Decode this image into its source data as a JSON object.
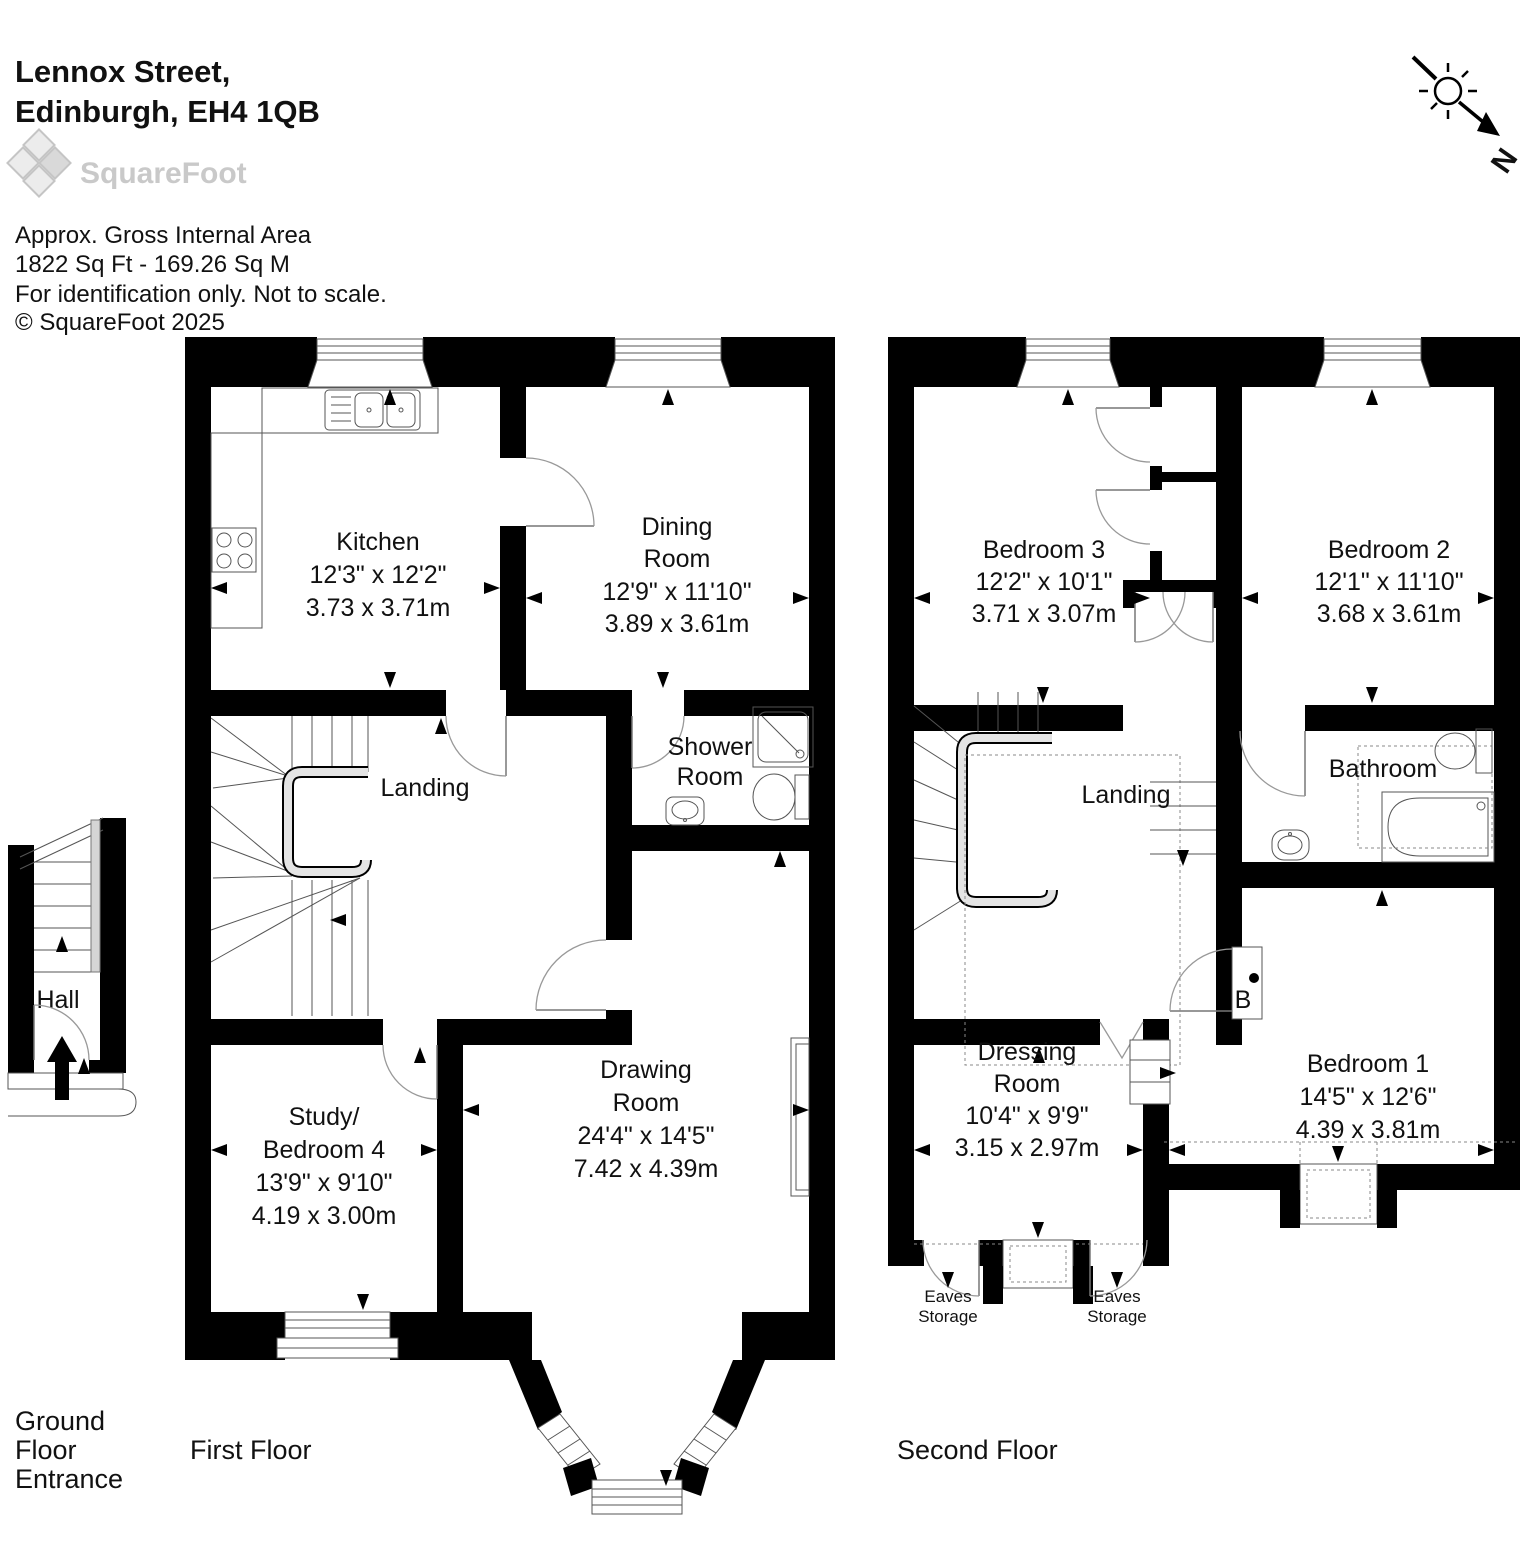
{
  "header": {
    "title_line1": "Lennox Street,",
    "title_line2": "Edinburgh, EH4 1QB",
    "logo": "SquareFoot",
    "area_line1": "Approx. Gross Internal Area",
    "area_line2": "1822 Sq Ft  -  169.26 Sq M",
    "area_line3": "For identification only. Not to scale.",
    "area_line4": "© SquareFoot 2025"
  },
  "compass": {
    "north_label": "N"
  },
  "floor_labels": {
    "ground_line1": "Ground",
    "ground_line2": "Floor",
    "ground_line3": "Entrance",
    "first": "First Floor",
    "second": "Second Floor"
  },
  "rooms": {
    "hall": {
      "name": "Hall"
    },
    "kitchen": {
      "name": "Kitchen",
      "ft": "12'3\" x 12'2\"",
      "m": "3.73 x 3.71m"
    },
    "dining": {
      "name1": "Dining",
      "name2": "Room",
      "ft": "12'9\" x 11'10\"",
      "m": "3.89 x 3.61m"
    },
    "landing_first": {
      "name": "Landing"
    },
    "shower": {
      "name1": "Shower",
      "name2": "Room"
    },
    "study": {
      "name1": "Study/",
      "name2": "Bedroom 4",
      "ft": "13'9\" x 9'10\"",
      "m": "4.19 x 3.00m"
    },
    "drawing": {
      "name1": "Drawing",
      "name2": "Room",
      "ft": "24'4\" x 14'5\"",
      "m": "7.42 x 4.39m"
    },
    "bedroom3": {
      "name": "Bedroom 3",
      "ft": "12'2\" x 10'1\"",
      "m": "3.71 x 3.07m"
    },
    "bedroom2": {
      "name": "Bedroom 2",
      "ft": "12'1\" x 11'10\"",
      "m": "3.68 x 3.61m"
    },
    "landing_second": {
      "name": "Landing"
    },
    "bathroom": {
      "name": "Bathroom"
    },
    "bedroom1": {
      "name": "Bedroom 1",
      "ft": "14'5\" x 12'6\"",
      "m": "4.39 x 3.81m"
    },
    "dressing": {
      "name1": "Dressing",
      "name2": "Room",
      "ft": "10'4\" x 9'9\"",
      "m": "3.15 x 2.97m"
    },
    "boiler": {
      "label": "B"
    },
    "eaves_left": {
      "line1": "Eaves",
      "line2": "Storage"
    },
    "eaves_right": {
      "line1": "Eaves",
      "line2": "Storage"
    }
  }
}
